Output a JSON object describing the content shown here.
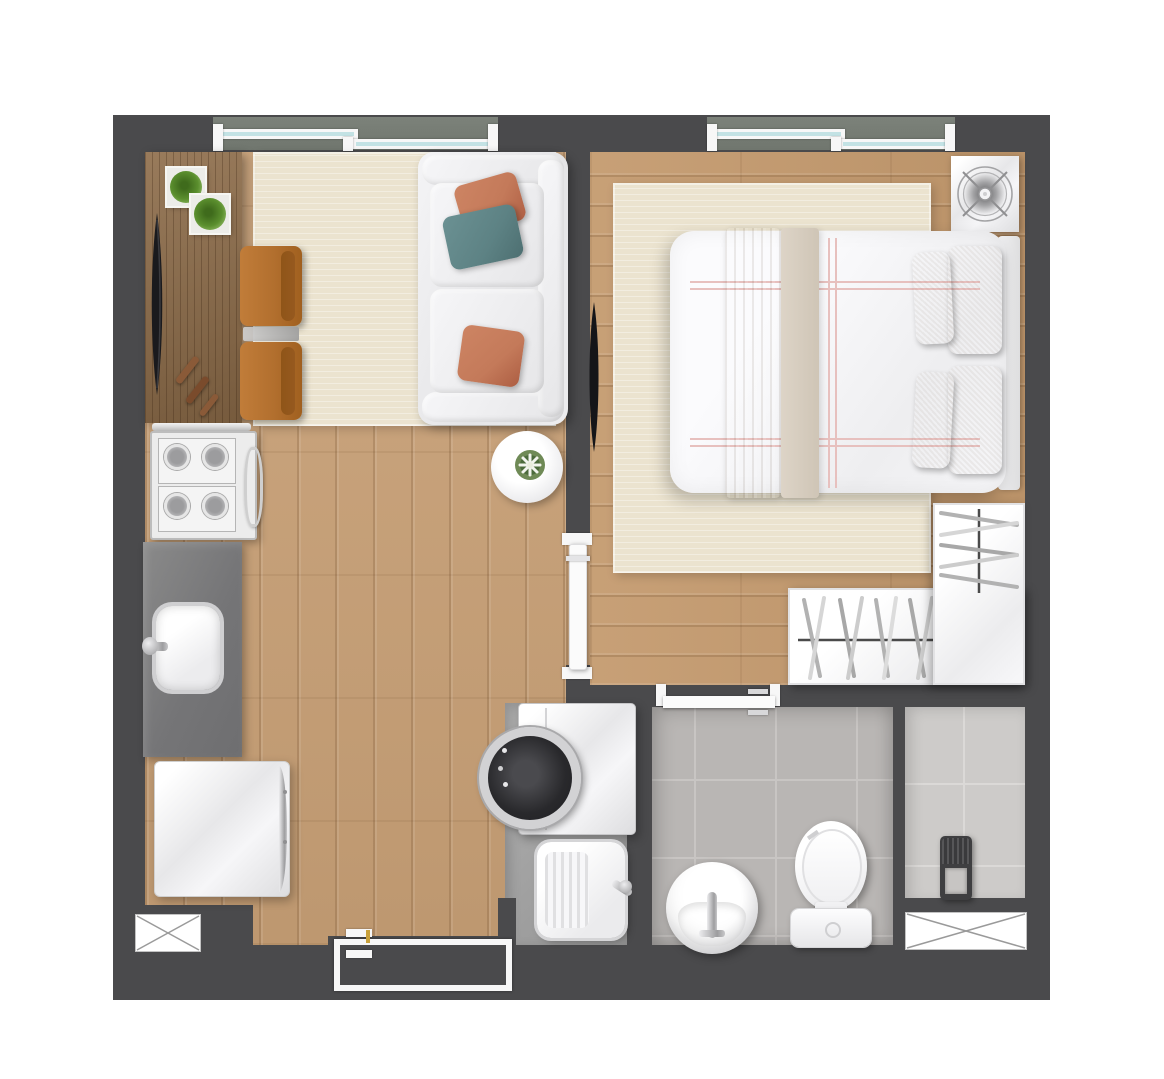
{
  "title": "studio-apartment-floor-plan",
  "colors": {
    "bg": "#ffffff",
    "wall": "#4a4a4c",
    "wood_living": "#c8a076",
    "wood_bedroom": "#c49a6e",
    "sideboard": "#8d6c49",
    "rug": "#ebe3cf",
    "counter": "#7b7b7b",
    "laundry_floor": "#a0a0a0",
    "tile_bath": "#b9b6b4",
    "tile_bath_line": "#c8c5c3",
    "tile_shower": "#cdcbc9",
    "tile_shower_line": "#dbd9d7",
    "chair": "#b26f2e",
    "chair_back": "#96591f",
    "pillow_orange": "#c47a5a",
    "pillow_teal": "#5d8284",
    "pillow_beige": "#d9cebe",
    "bed_stripe": "#e7c0be",
    "bed_throw": "#d0c5b6",
    "glass": "#c3e2e4",
    "ledge": "#70766e",
    "plant": "#5b8f2e",
    "tv": "#18181b",
    "chrome": "#c9c9cb",
    "frame_white": "#f7f7f7",
    "door_white": "#fbfbfb",
    "heater_dark": "#3f3f41"
  },
  "rooms": {
    "living": "living-room",
    "kitchen": "kitchen",
    "hallway": "hallway",
    "bedroom": "bedroom",
    "bathroom": "bathroom",
    "laundry": "laundry-area",
    "shower": "shower-area"
  },
  "items": {
    "window_left": "sliding-window",
    "window_right": "sliding-window",
    "sideboard": "tv-sideboard",
    "tv_living": "television",
    "plant_a": "plant-box",
    "plant_b": "plant-box",
    "remotes": "remote-controls",
    "armchair_a": "armchair",
    "armchair_b": "armchair",
    "chair_table": "side-table",
    "living_rug": "area-rug",
    "sofa": "sofa",
    "round_table": "round-side-table",
    "stove": "cooktop",
    "counter": "kitchen-counter",
    "kitchen_sink": "kitchen-sink",
    "fridge": "refrigerator",
    "entry_door": "entry-door",
    "shaft_left": "shaft",
    "washer": "washing-machine",
    "laundry_tank": "laundry-sink",
    "bath_door": "bathroom-door",
    "bath_sink": "washbasin",
    "toilet": "toilet",
    "heater": "water-heater",
    "shaft_right": "shaft",
    "bed": "double-bed",
    "bed_rug": "area-rug",
    "tv_bedroom": "television",
    "fan": "ventilation-fan",
    "wardrobe": "wardrobe",
    "bedroom_door": "bedroom-door"
  }
}
